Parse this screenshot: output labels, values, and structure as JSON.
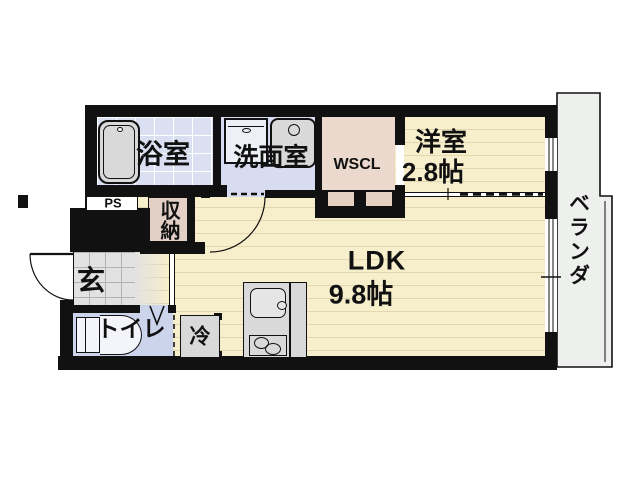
{
  "title": "1R/1LDK apartment floor plan",
  "rooms": {
    "bathroom": {
      "label": "浴室"
    },
    "washroom": {
      "label": "洗面室"
    },
    "walk_in_closet": {
      "label": "WSCL"
    },
    "western_room": {
      "label": "洋室",
      "size": "2.8帖"
    },
    "veranda": {
      "label": "ベランダ"
    },
    "pipe_space": {
      "label": "PS"
    },
    "storage": {
      "label": "収納"
    },
    "entrance": {
      "label": "玄"
    },
    "ldk": {
      "label": "LDK",
      "size": "9.8帖"
    },
    "toilet": {
      "label": "トイレ"
    },
    "refrigerator": {
      "label": "冷"
    }
  },
  "colors": {
    "wall": "#111111",
    "wood": "#f7eecb",
    "wood_stripe": "#e2d7ae",
    "bath_floor": "#dadff2",
    "washroom_floor": "#d7dcf1",
    "toilet_floor": "#ccd4ec",
    "closet": "#ead9cc",
    "storage": "#e2cfc5",
    "tile": "#e2e2e2",
    "tile_line": "#b2b2b2",
    "fixture": "#d9d9d9",
    "veranda": "#eef0ee",
    "text": "#111111",
    "bg": "#ffffff"
  }
}
